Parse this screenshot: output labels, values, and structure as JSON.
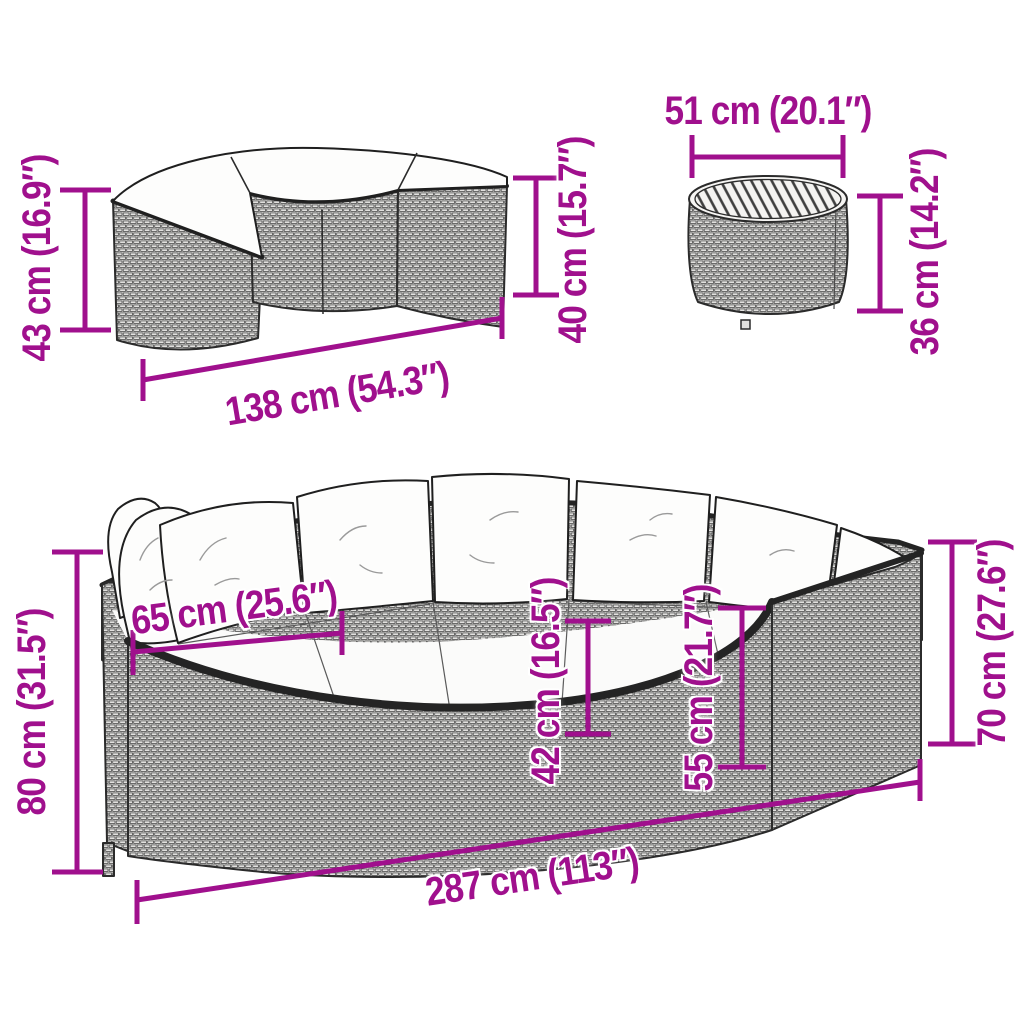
{
  "diagram": {
    "labels": {
      "bench_height": "43 cm (16.9″)",
      "bench_width": "138 cm (54.3″)",
      "bench_seat_height": "40 cm (15.7″)",
      "table_diameter": "51 cm (20.1″)",
      "table_height": "36 cm (14.2″)",
      "sofa_total_height": "80 cm (31.5″)",
      "sofa_seat_depth": "65 cm (25.6″)",
      "sofa_seat_height": "42 cm (16.5″)",
      "sofa_arm_height": "55 cm (21.7″)",
      "sofa_back_height": "70 cm (27.6″)",
      "sofa_width": "287 cm (113″)"
    },
    "colors": {
      "dimension": "#A0108D",
      "outline": "#2b2b2b",
      "cushion": "#fdfdfc"
    }
  }
}
